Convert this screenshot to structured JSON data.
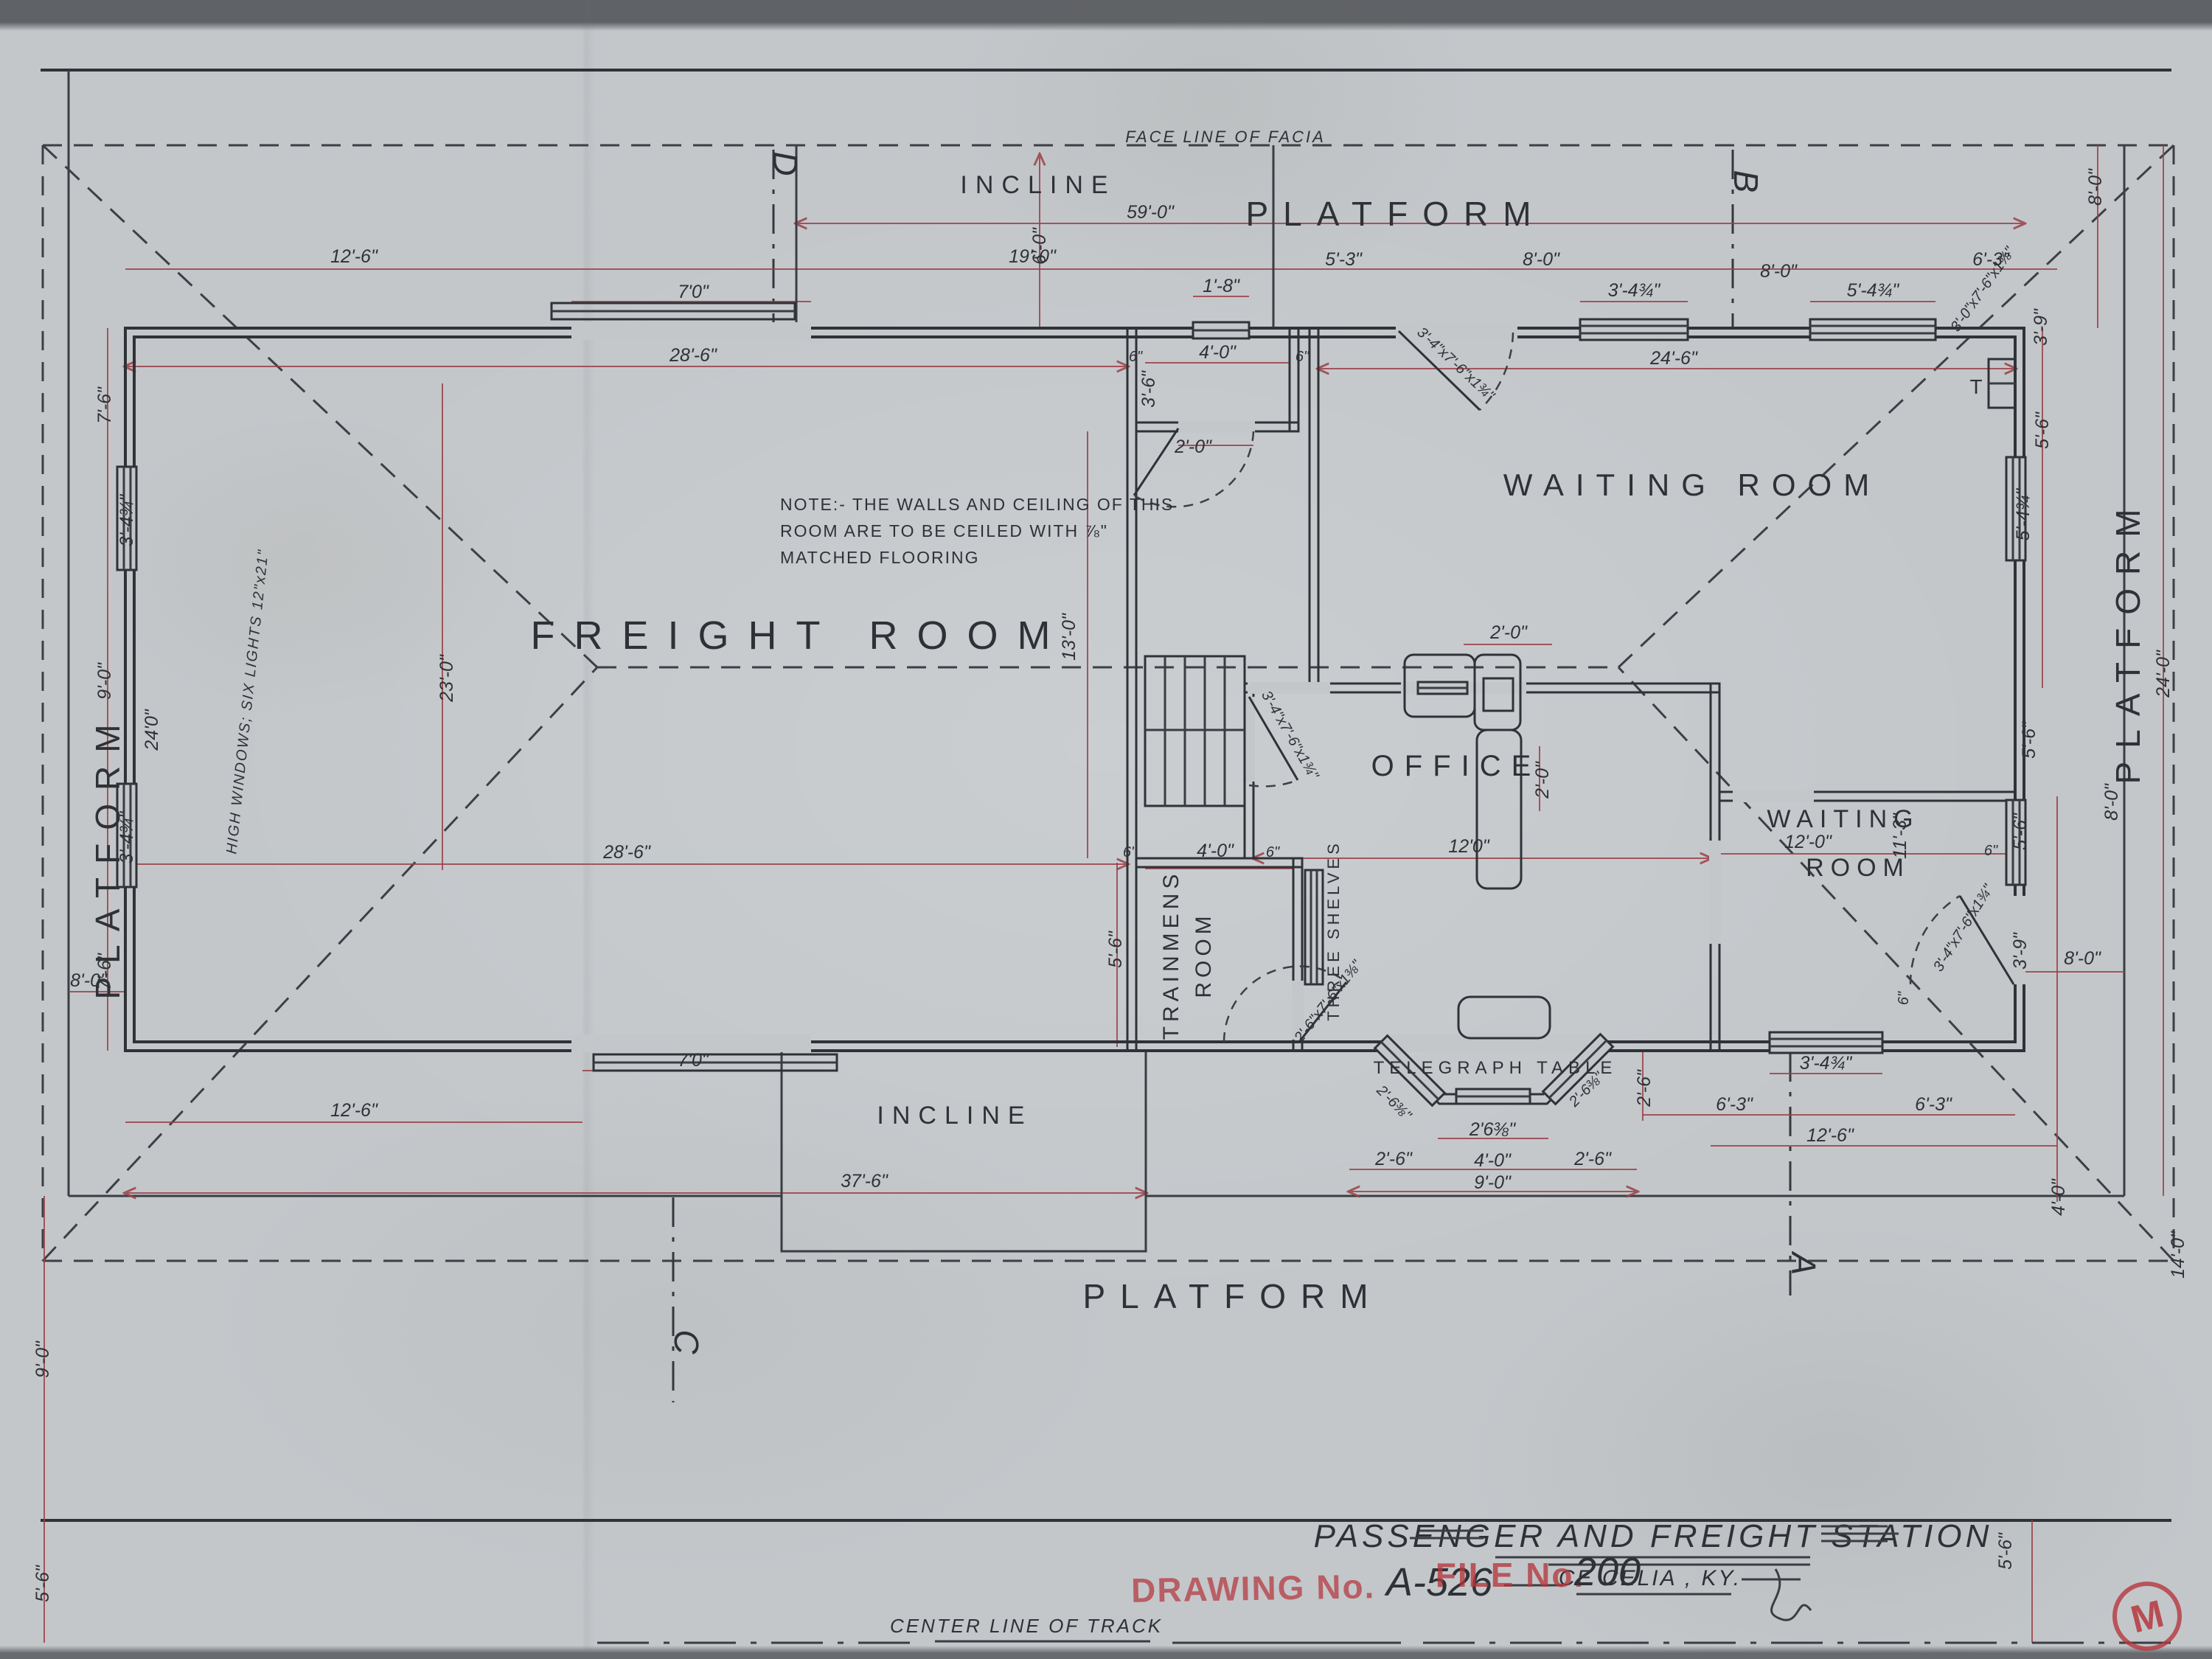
{
  "title_block": {
    "title": "PASSENGER AND FREIGHT STATION",
    "location": "CE CELIA , KY.",
    "drawing_no_label": "DRAWING No.",
    "drawing_no": "A-526",
    "file_no_label": "FILE No.",
    "file_no": "200",
    "center_line": "CENTER LINE OF TRACK",
    "monogram": "M"
  },
  "labels": {
    "freight_room": "FREIGHT ROOM",
    "waiting_room": "WAITING ROOM",
    "waiting": "WAITING",
    "room": "ROOM",
    "office": "OFFICE",
    "trainmens": "TRAINMENS",
    "trainmens_room": "ROOM",
    "incline": "INCLINE",
    "platform": "PLATFORM",
    "telegraph_table": "TELEGRAPH TABLE",
    "three_shelves": "THREE SHELVES",
    "face_line": "FACE LINE OF FACIA",
    "chimney": "T",
    "high_windows": "HIGH WINDOWS; SIX LIGHTS 12\"x21\""
  },
  "note": {
    "l1": "NOTE:- THE WALLS AND CEILING OF THIS",
    "l2": "ROOM ARE TO BE CEILED WITH ⅞\"",
    "l3": "MATCHED FLOORING"
  },
  "sections": {
    "a": "A",
    "b": "B",
    "c": "C",
    "d": "D"
  },
  "door_notes": {
    "a": "3'-4\"x7'-6\"x1¾\"",
    "b": "2'-6\"x7'-6\"x1⅜\"",
    "c": "3'-0\"x7'-6\"x1⅜\""
  },
  "dims": {
    "d59": "59'-0\"",
    "d12_6t": "12'-6\"",
    "d19": "19'-0\"",
    "d5_3": "5'-3\"",
    "d8a": "8'-0\"",
    "d8b": "8'-0\"",
    "d6_3t": "6'-3\"",
    "d7t": "7'0\"",
    "d1_8": "1'-8\"",
    "d3_4a": "3'-4¾\"",
    "d5_4a": "5'-4¾\"",
    "d28_6t": "28'-6\"",
    "d24_6": "24'-6\"",
    "d4_0v": "4'-0\"",
    "d6a": "6\"",
    "d6b": "6\"",
    "d3_6v": "3'-6\"",
    "d2_0d": "2'-0\"",
    "d6_0inc": "6'-0\"",
    "l7_6a": "7'-6\"",
    "l3_4a": "3'-4¾\"",
    "l9_0": "9'-0\"",
    "l3_4b": "3'-4¾\"",
    "l7_6b": "7'-6\"",
    "l8_0": "8'-0\"",
    "l24": "24'0\"",
    "l9_0b": "9'-0\"",
    "l5_6": "5'-6\"",
    "f23": "23'-0\"",
    "f28_6": "28'-6\"",
    "f13": "13'-0\"",
    "t5_6": "5'-6\"",
    "t4_0": "4'-0\"",
    "t6a": "6\"",
    "t6b": "6\"",
    "o12": "12'0\"",
    "d2_0desk": "2'-0\"",
    "o2_0r": "2'-0\"",
    "w12": "12'-0\"",
    "w11_3": "11'-3\"",
    "w6a": "6\"",
    "w5_6r": "5'-6\"",
    "w3_9r": "3'-9\"",
    "w8_0": "8'-0\"",
    "w6b": "6\"",
    "w3_4": "3'-4¾\"",
    "w6_3a": "6'-3\"",
    "w6_3b": "6'-3\"",
    "w12_6": "12'-6\"",
    "r8t": "8'-0\"",
    "r3_9": "3'-9\"",
    "r5_6a": "5'-6\"",
    "r5_4": "5'-4¾\"",
    "r5_6b": "5'-6\"",
    "r24": "24'-0\"",
    "r8b": "8'-0\"",
    "r14": "14'-0\"",
    "r4_0": "4'-0\"",
    "r5_6c": "5'-6\"",
    "b2_63l": "2'-6⅜\"",
    "b2_63r": "2'-6⅜\"",
    "b2_63c": "2'6⅜\"",
    "b2_6a": "2'-6\"",
    "b4_0": "4'-0\"",
    "b2_6b": "2'-6\"",
    "b9_0": "9'-0\"",
    "b2_6v": "2'-6\"",
    "bot12_6": "12'-6\"",
    "bot7": "7'0\"",
    "bot37_6": "37'-6\""
  },
  "colors": {
    "paper": "#c3c7ca",
    "ink": "#2e3136",
    "dim_red": "#9b4148",
    "stamp_red": "#b5373d"
  }
}
